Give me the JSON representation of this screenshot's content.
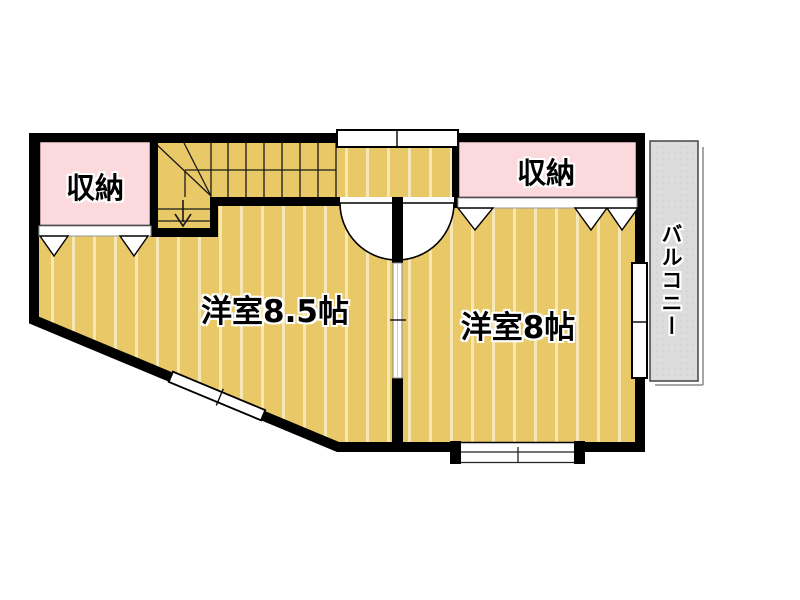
{
  "plan": {
    "labels": {
      "room_85": "洋室8.5帖",
      "room_8": "洋室8帖",
      "closet_left": "収納",
      "closet_right": "収納",
      "balcony": "バルコニー"
    },
    "colors": {
      "wall": "#000000",
      "floor": "#e9c867",
      "floor_stripe": "#f6e8b4",
      "closet": "#fbd9dc",
      "balcony": "#dcdcdc",
      "background": "#ffffff"
    }
  }
}
